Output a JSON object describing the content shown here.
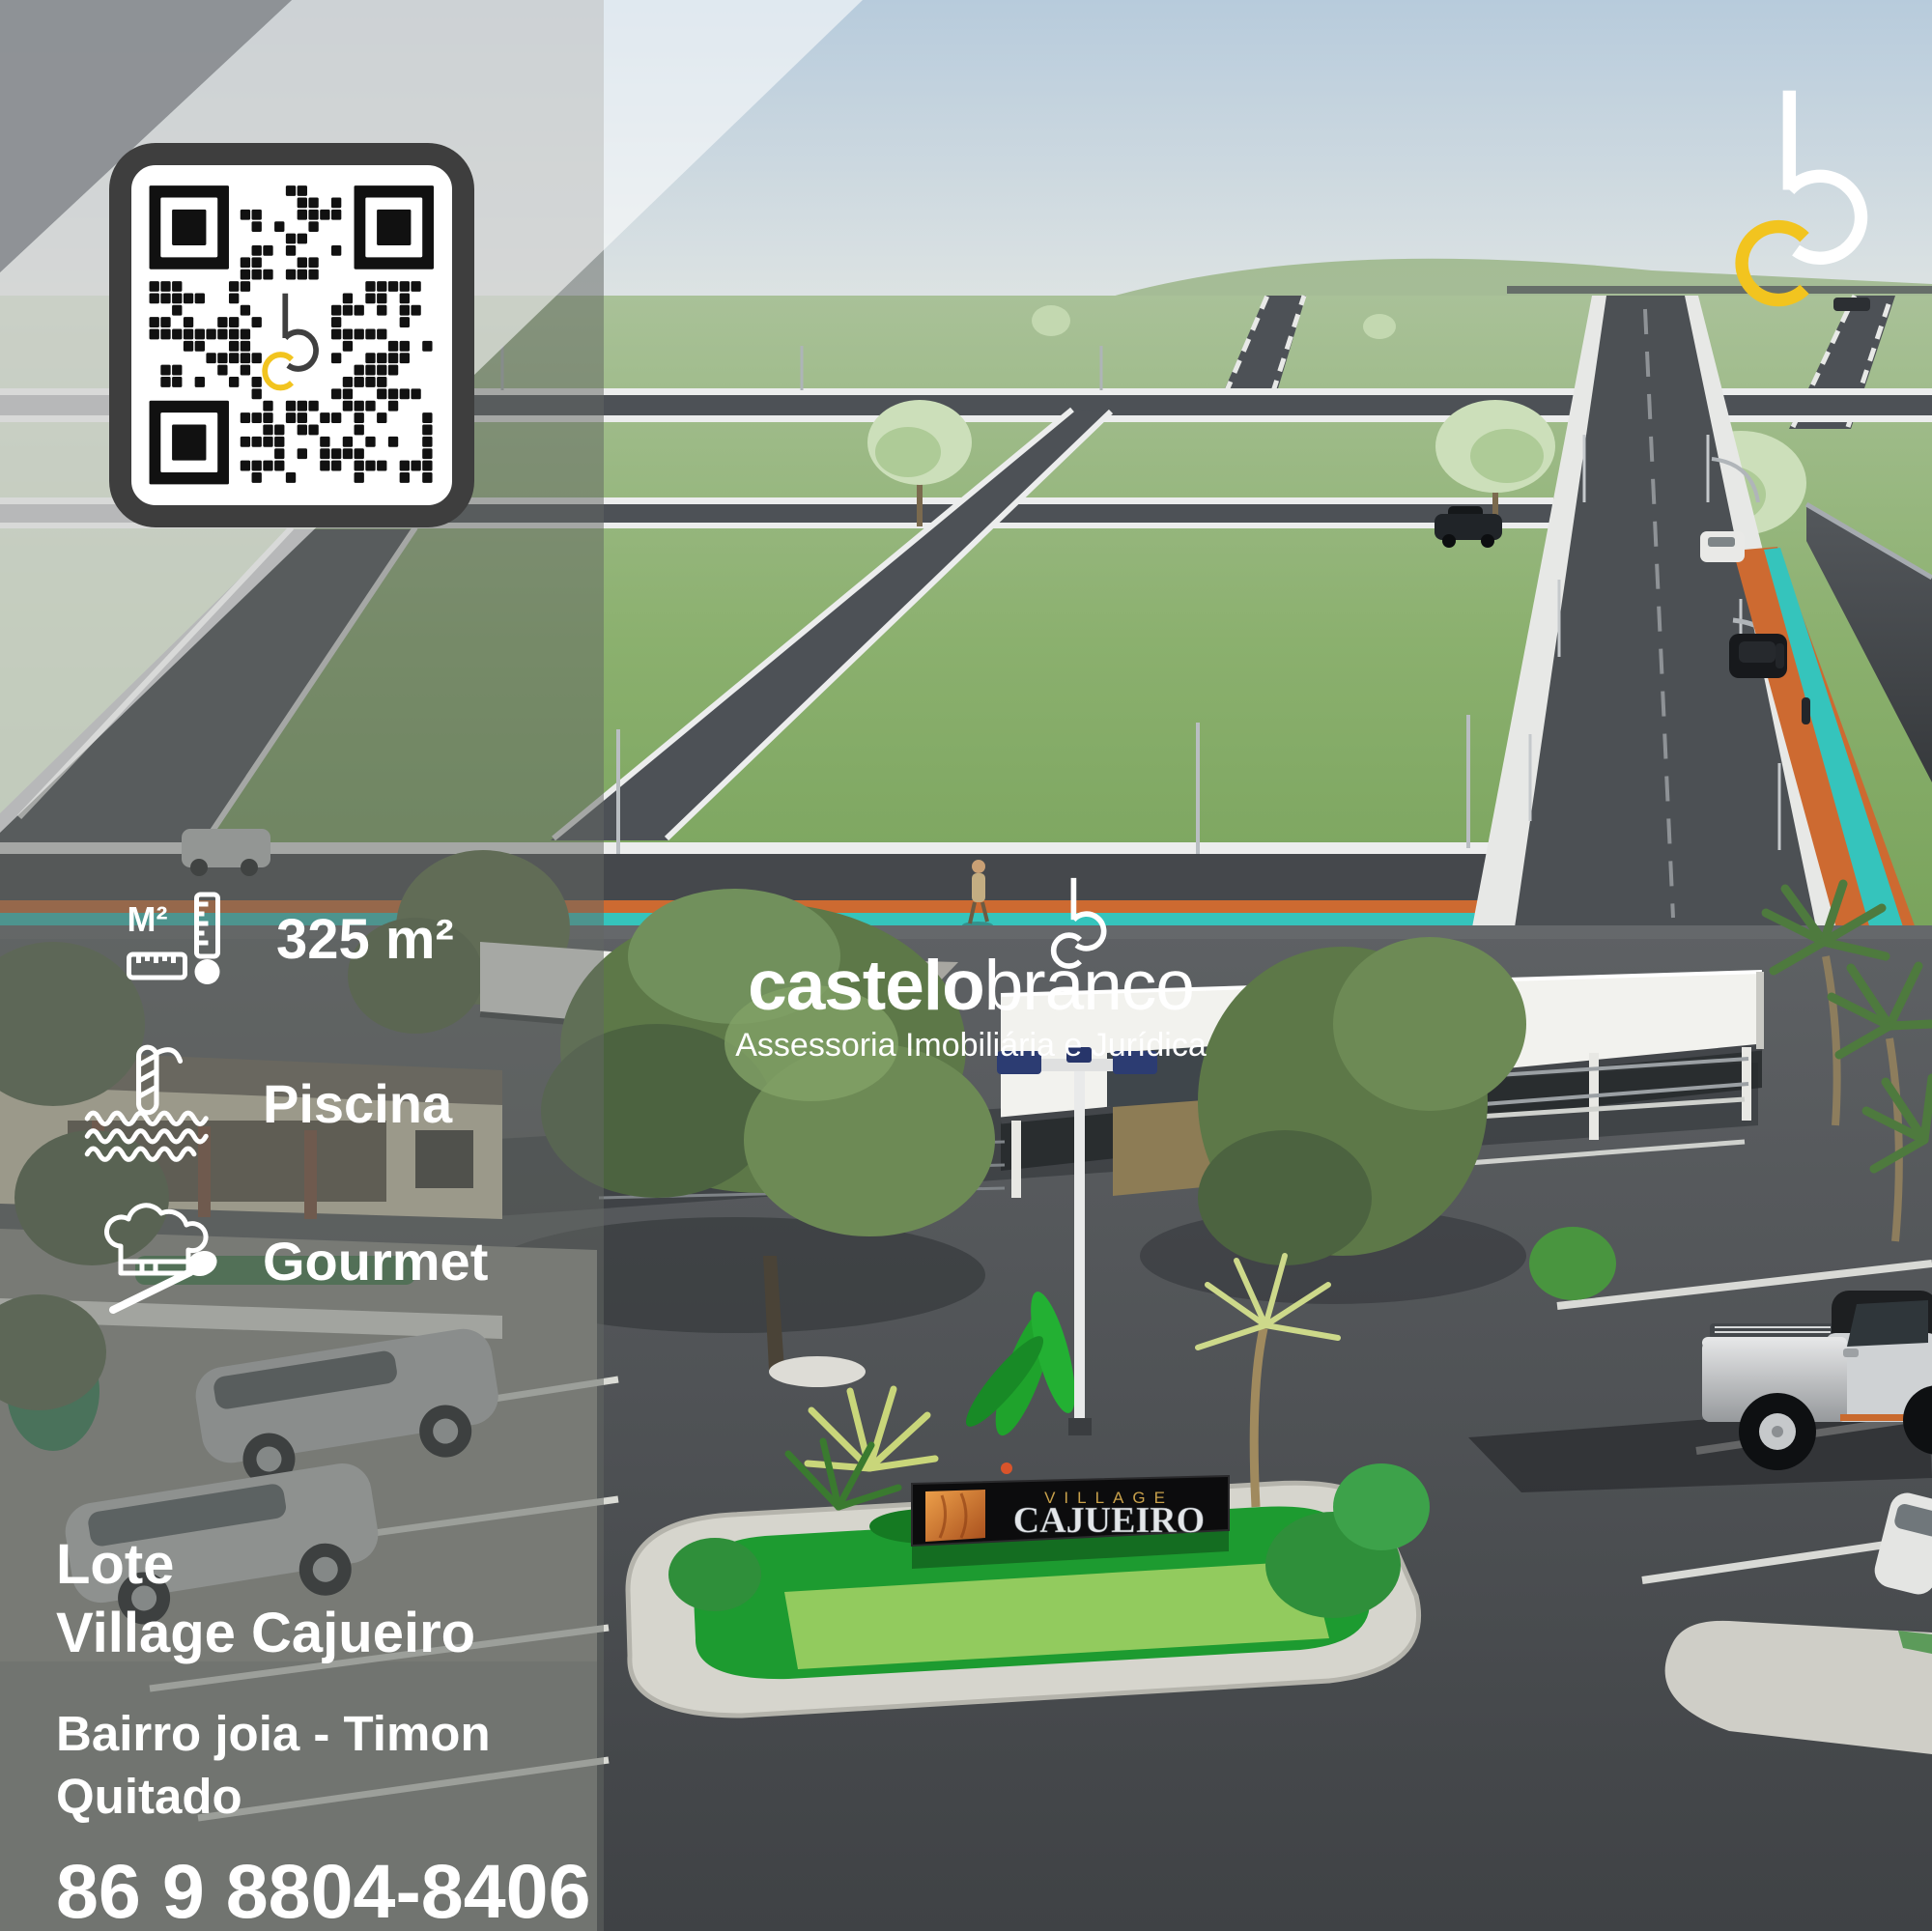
{
  "listing": {
    "line1": "Lote",
    "line2": "Village Cajueiro",
    "location": "Bairro joia - Timon",
    "status": "Quitado",
    "phone": "86 9 8804-8406"
  },
  "features": [
    {
      "name": "area",
      "icon": "ruler-area-icon",
      "icon_text": "M²",
      "label": "325 m²"
    },
    {
      "name": "pool",
      "icon": "pool-ladder-icon",
      "label": "Piscina"
    },
    {
      "name": "gourmet",
      "icon": "chef-hat-spoon-icon",
      "label": "Gourmet"
    }
  ],
  "brand": {
    "logo": "bc-monogram",
    "name_bold": "castelo",
    "name_light": "branco",
    "tagline": "Assessoria Imobiliária e Jurídica"
  },
  "entrance_sign": {
    "line1": "VILLAGE",
    "line2": "CAJUEIRO"
  },
  "colors": {
    "accent_yellow": "#F2C41F",
    "accent_orange": "#CD6A31",
    "accent_teal": "#35C4BC",
    "overlay_gray": "#8E9296",
    "sign_gold": "#C9A14B"
  }
}
